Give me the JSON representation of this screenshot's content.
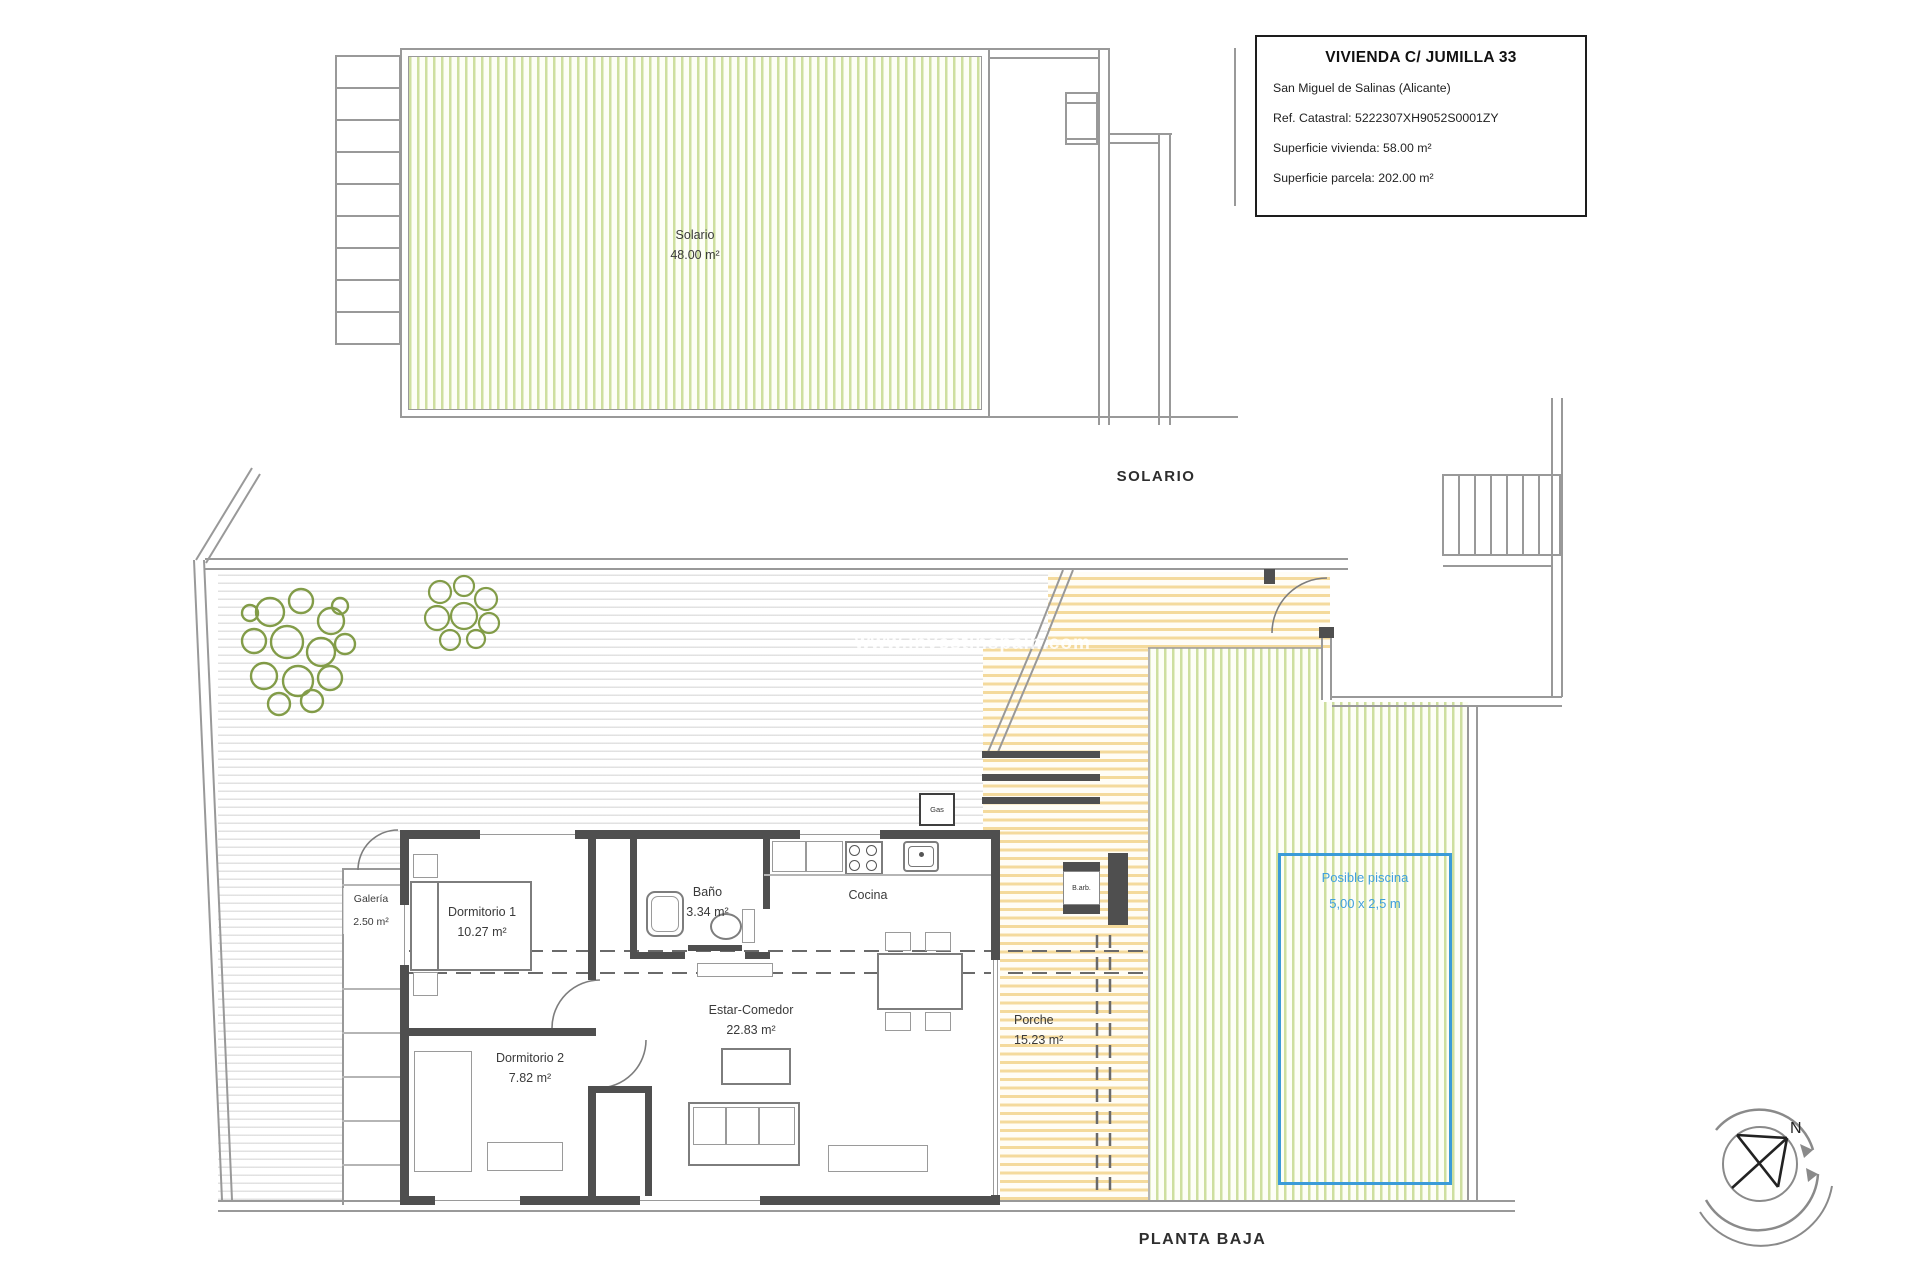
{
  "title_block": {
    "title": "VIVIENDA C/ JUMILLA 33",
    "location": "San Miguel de Salinas (Alicante)",
    "cadastral": "Ref. Catastral: 5222307XH9052S0001ZY",
    "dwelling_area": "Superficie vivienda: 58.00 m²",
    "plot_area": "Superficie parcela: 202.00 m²"
  },
  "solario_plan": {
    "caption": "SOLARIO",
    "room": {
      "name": "Solario",
      "area": "48.00 m²"
    }
  },
  "ground_plan": {
    "caption": "PLANTA BAJA",
    "rooms": {
      "dormitorio1": {
        "name": "Dormitorio 1",
        "area": "10.27 m²"
      },
      "dormitorio2": {
        "name": "Dormitorio 2",
        "area": "7.82 m²"
      },
      "bano": {
        "name": "Baño",
        "area": "3.34 m²"
      },
      "cocina": {
        "name": "Cocina"
      },
      "estar": {
        "name": "Estar-Comedor",
        "area": "22.83 m²"
      },
      "galeria": {
        "name": "Galería",
        "area": "2.50 m²"
      },
      "porche": {
        "name": "Porche",
        "area": "15.23 m²"
      }
    },
    "pool": {
      "label": "Posible piscina",
      "size": "5,00 x 2,5 m"
    },
    "annotations": {
      "gas": "Gas",
      "barbecue": "B.arb."
    }
  },
  "watermark": "www.investinspain.com",
  "compass": {
    "north": "N"
  },
  "colors": {
    "garden_stripe": "#b9d077",
    "porch_stripe": "#f0c874",
    "patio_stripe": "#d9d9d9",
    "wall": "#4f4f4f",
    "pool_border": "#3b9bd8",
    "pool_text": "#41a0dd"
  }
}
